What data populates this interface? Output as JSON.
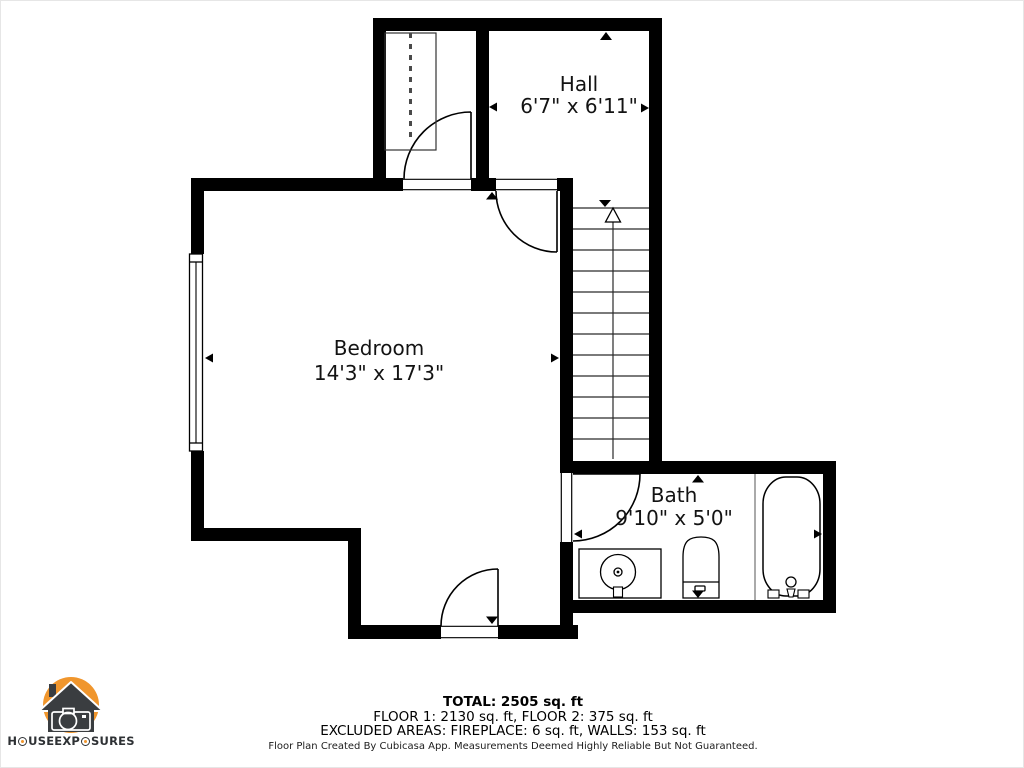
{
  "colors": {
    "wall": "#000000",
    "background": "#ffffff",
    "line": "#1a1a1a",
    "logo_orange": "#F0962D",
    "logo_dark": "#3A3D40",
    "logo_text": "#2E3134"
  },
  "floorplan": {
    "rooms": [
      {
        "name": "Hall",
        "dimensions": "6'7\" x 6'11\""
      },
      {
        "name": "Bedroom",
        "dimensions": "14'3\" x 17'3\""
      },
      {
        "name": "Bath",
        "dimensions": "9'10\" x 5'0\""
      }
    ],
    "stairs_direction": "up",
    "fixture_icons": [
      "stairs-up-arrow-icon",
      "closet-rod-icon",
      "window",
      "sink-icon",
      "toilet-icon",
      "bathtub-icon",
      "door-swing-icon"
    ]
  },
  "summary": {
    "total": "TOTAL: 2505 sq. ft",
    "floors": "FLOOR 1: 2130 sq. ft, FLOOR 2: 375 sq. ft",
    "excluded": "EXCLUDED AREAS: FIREPLACE: 6 sq. ft, WALLS: 153 sq. ft",
    "disclaimer": "Floor Plan Created By Cubicasa App. Measurements Deemed Highly Reliable But Not Guaranteed."
  },
  "logo": {
    "text": "HOUSE EXPOSURES"
  }
}
